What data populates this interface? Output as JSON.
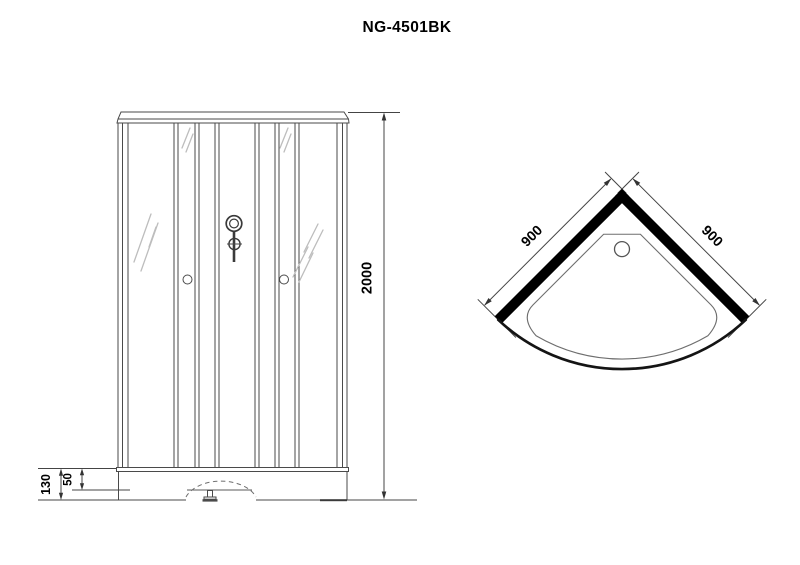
{
  "title": "NG-4501BK",
  "front_view": {
    "height_dim": "2000",
    "base_height_dim": "130",
    "base_inner_dim": "50"
  },
  "plan_view": {
    "left_dim": "900",
    "right_dim": "900"
  },
  "colors": {
    "background": "#ffffff",
    "line": "#4a4a4a",
    "wall_fill": "#000000",
    "hatch": "#bdbdbd",
    "text": "#000000"
  }
}
